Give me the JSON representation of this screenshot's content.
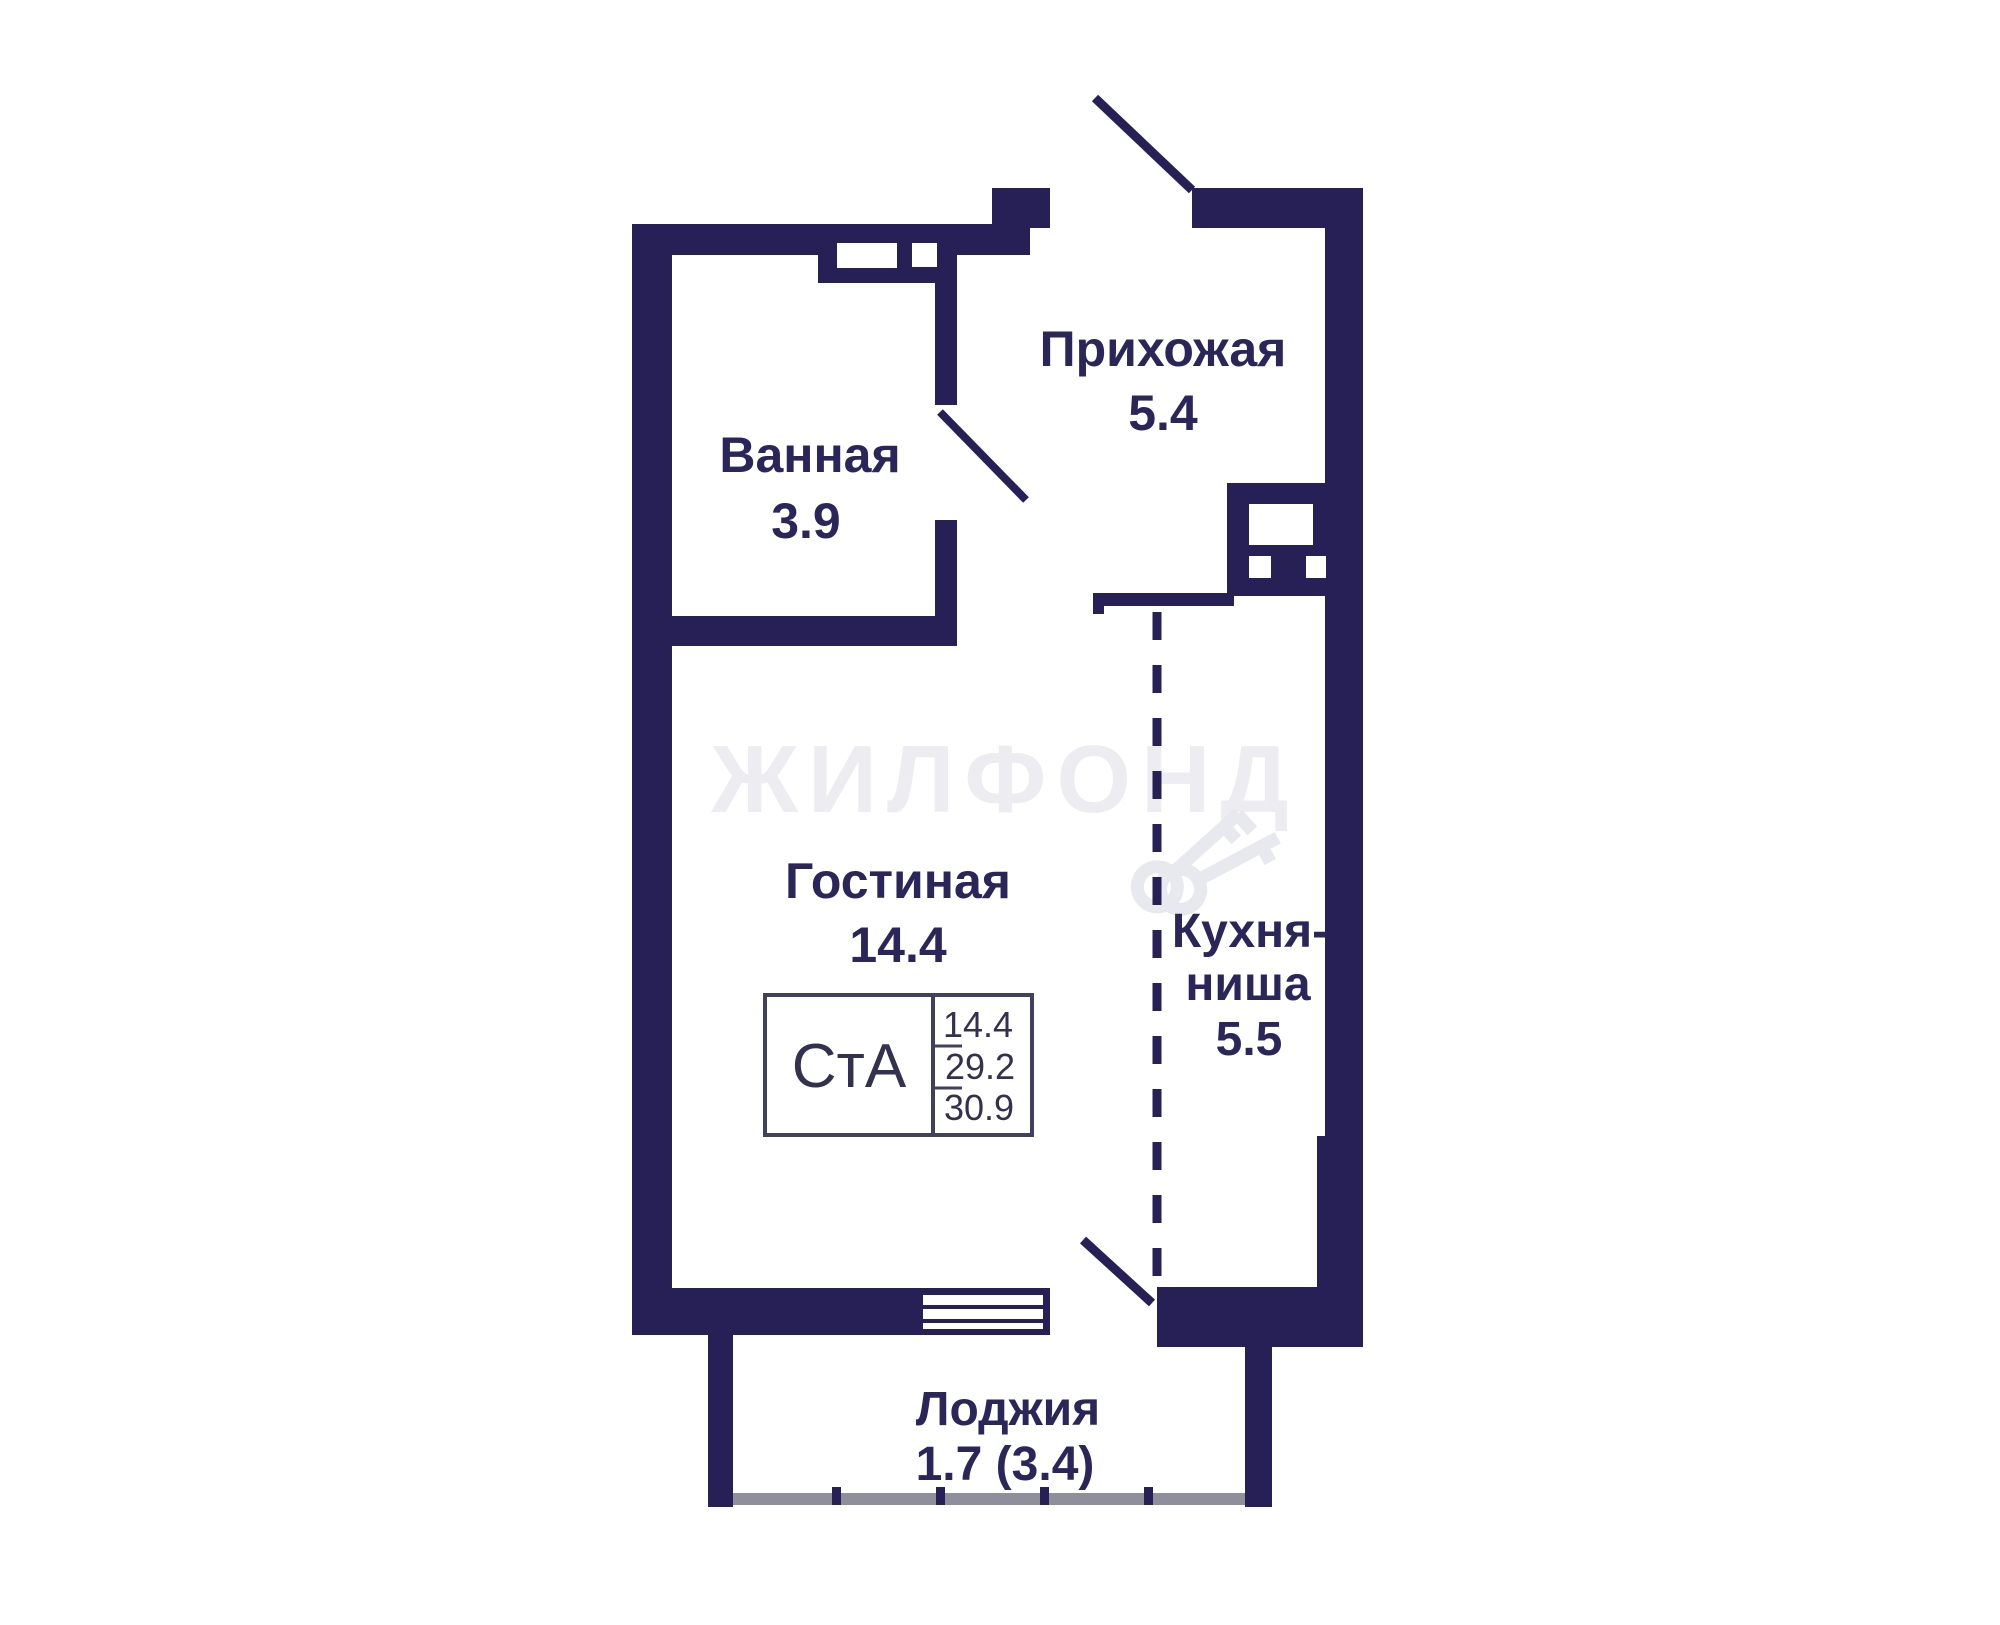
{
  "floorplan": {
    "watermark_text": "ЖИЛФОНД",
    "rooms": {
      "bathroom": {
        "label": "Ванная",
        "area": "3.9"
      },
      "hallway": {
        "label": "Прихожая",
        "area": "5.4"
      },
      "living_room": {
        "label": "Гостиная",
        "area": "14.4"
      },
      "kitchen_niche": {
        "label_line1": "Кухня-",
        "label_line2": "ниша",
        "area": "5.5"
      },
      "loggia": {
        "label": "Лоджия",
        "area": "1.7 (3.4)"
      }
    },
    "stamp": {
      "apartment_type": "СтА",
      "living_area": "14.4",
      "area_no_loggia": "29.2",
      "total_area": "30.9"
    },
    "colors": {
      "wall": "#262057",
      "label_text": "#2b2659",
      "stamp_border": "#41405e",
      "railing_gray": "#8f8f9c",
      "watermark": "#ededf1",
      "background": "#ffffff"
    }
  }
}
